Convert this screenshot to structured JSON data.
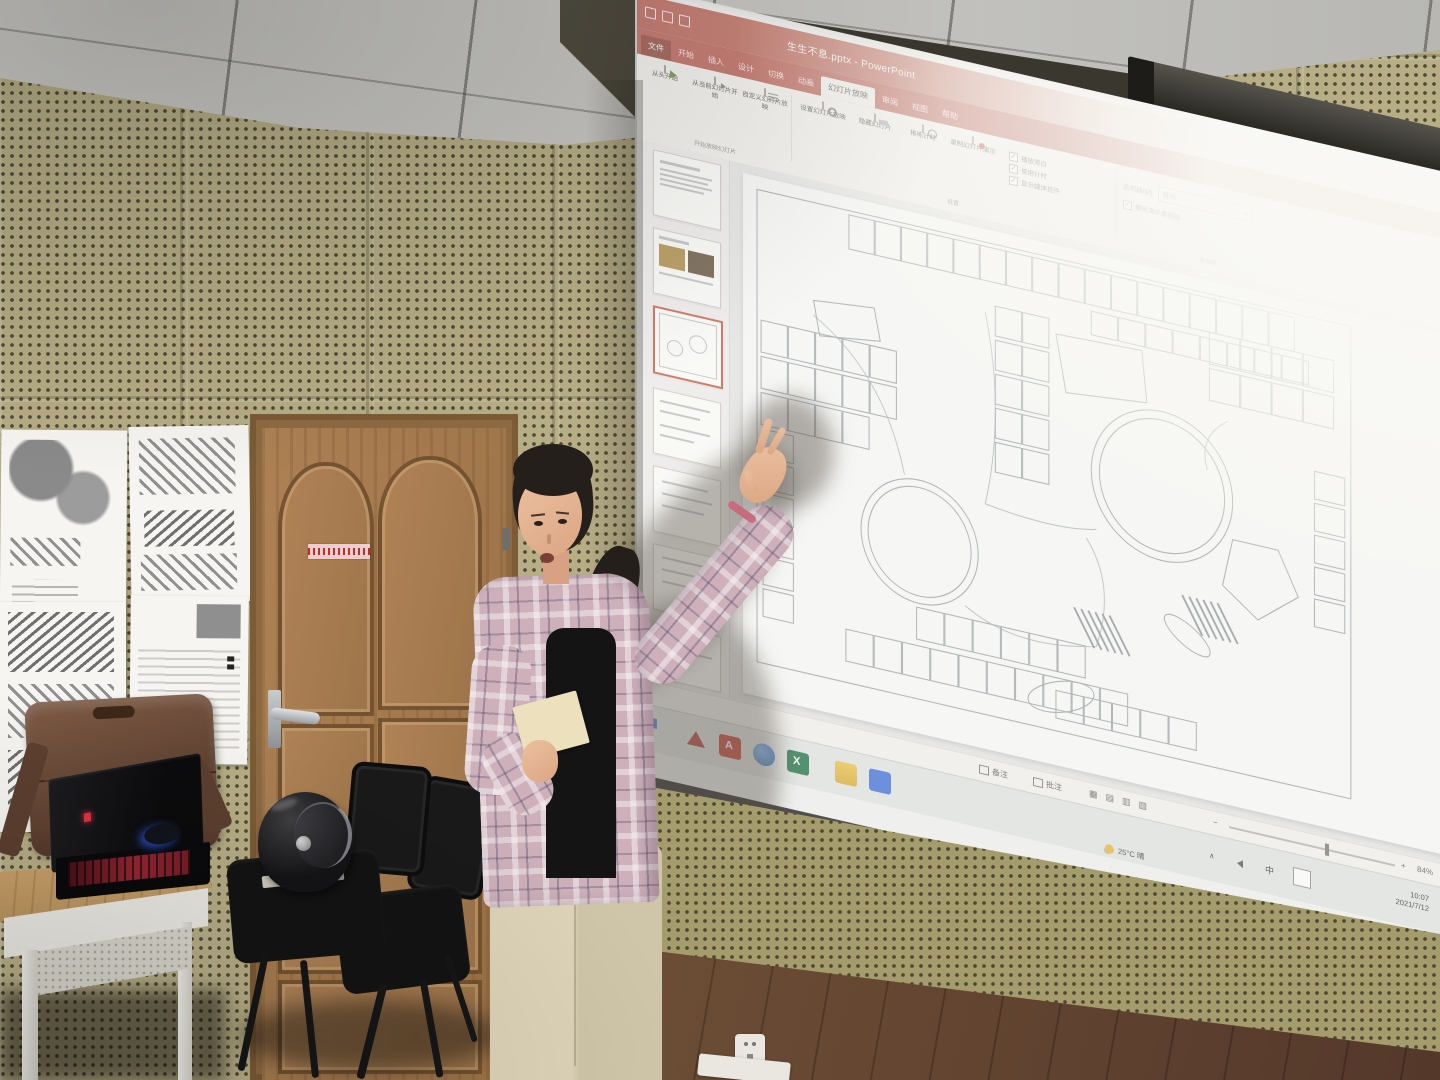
{
  "window": {
    "title": "生生不息.pptx - PowerPoint",
    "tabs": [
      "文件",
      "开始",
      "插入",
      "设计",
      "切换",
      "动画",
      "幻灯片放映",
      "审阅",
      "视图",
      "帮助"
    ],
    "active_tab": "幻灯片放映",
    "ribbon": {
      "start_group": {
        "caption": "开始放映幻灯片",
        "buttons": [
          "从头开始",
          "从当前幻灯片开始",
          "自定义幻灯片放映"
        ]
      },
      "setup_group": {
        "caption": "设置",
        "buttons": [
          "设置幻灯片放映",
          "隐藏幻灯片",
          "排练计时",
          "录制幻灯片演示"
        ],
        "checkboxes": [
          "播放旁白",
          "使用计时",
          "显示媒体控件"
        ]
      },
      "monitor_group": {
        "caption": "监视器",
        "label": "监视器(M):",
        "value": "自动",
        "checkbox": "使用演示者视图"
      }
    },
    "status_bar": {
      "notes": "备注",
      "comments": "批注",
      "zoom_percent": "84%"
    }
  },
  "taskbar": {
    "weather": "25°C 晴",
    "tray_chevron": "∧",
    "ime": "中",
    "time": "10:07",
    "date": "2021/7/12"
  },
  "colors": {
    "ppt_accent": "#b5564a",
    "selected_thumb_border": "#c4553b",
    "keyboard_glow": "#a12937"
  }
}
